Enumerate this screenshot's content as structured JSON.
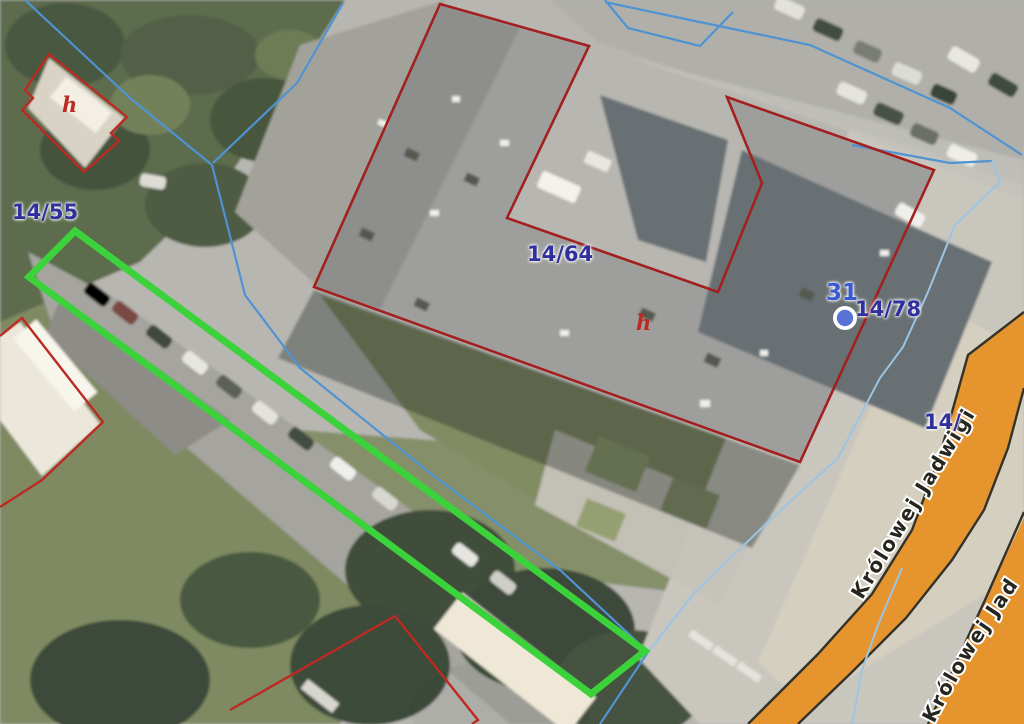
{
  "map_overlay": {
    "parcel_labels": [
      {
        "text": "14/55"
      },
      {
        "text": "14/64"
      },
      {
        "text": "14/78"
      },
      {
        "text": "14/"
      }
    ],
    "building_marks": [
      {
        "text": "h"
      },
      {
        "text": "h"
      }
    ],
    "point_marker": {
      "label": "31"
    },
    "street_labels": [
      {
        "name": "Królowej Jadwigi"
      },
      {
        "name": "Królowej Jad"
      }
    ],
    "legend_colors": {
      "selected_parcel_outline": "#3bd23b",
      "parcel_boundary_line": "#4f93d2",
      "parcel_boundary_line_light": "#9cc4e4",
      "building_outline": "#a32020",
      "building_outline_secondary": "#bc2a22",
      "road_fill": "#e5942e",
      "road_border": "#33322a",
      "street_label_color": "#26261f",
      "parcel_label_color": "#2f2f9d",
      "marker_label_color": "#3a5ad2",
      "marker_fill": "#5873d6"
    }
  }
}
